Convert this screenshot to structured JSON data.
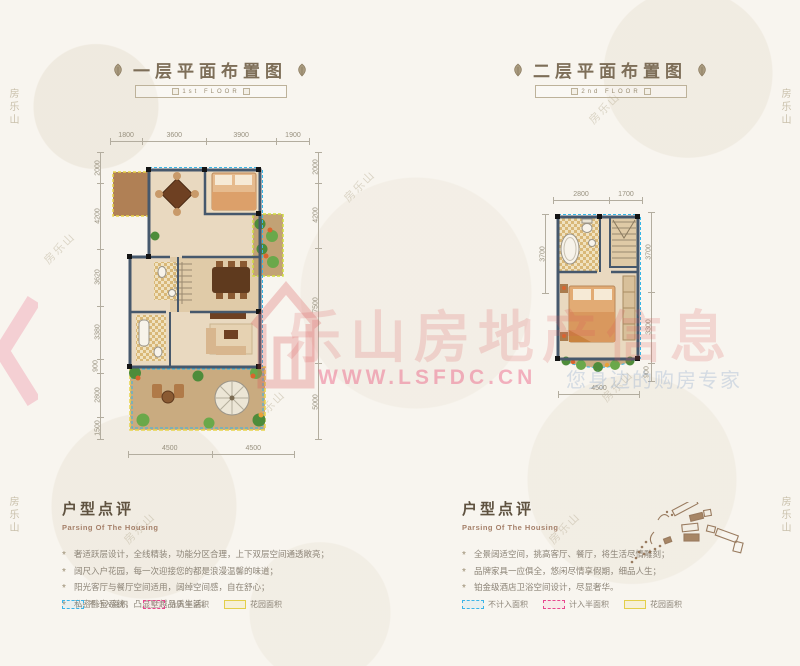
{
  "floor1": {
    "title": "一层平面布置图",
    "banner": "1st  FLOOR",
    "dims_top": [
      "1800",
      "3600",
      "3900",
      "1900"
    ],
    "dims_left": [
      "2000",
      "4200",
      "3620",
      "3380",
      "900",
      "2800",
      "1500"
    ],
    "dims_right": [
      "2000",
      "4200",
      "7500",
      "5000"
    ],
    "dims_bottom": [
      "4500",
      "4500"
    ]
  },
  "floor2": {
    "title": "二层平面布置图",
    "banner": "2nd  FLOOR",
    "dims_top": [
      "2800",
      "1700"
    ],
    "dims_left": [
      "3700"
    ],
    "dims_right": [
      "3700",
      "3300",
      "900"
    ],
    "dims_bottom": [
      "4500"
    ]
  },
  "watermark": {
    "brand_text": "乐山房地产信息",
    "url_text": "WWW.LSFDC.CN",
    "tagline": "您身边的购房专家",
    "corner_text": "房乐山"
  },
  "review_left": {
    "heading": "户型点评",
    "subheading": "Parsing Of The Housing",
    "bullets": [
      "奢适跃层设计，全线精装，功能分区合理，上下双层空间通透敞亮；",
      "阔尺入户花园，每一次迎接您的都是浪漫温馨的味道；",
      "阳光客厅与餐厅空间适用，阔绰空间感，自在舒心；",
      "私密卧室系统，凸显墅越品质生活。"
    ]
  },
  "review_right": {
    "heading": "户型点评",
    "subheading": "Parsing Of The Housing",
    "bullets": [
      "全景阔适空间，挑高客厅、餐厅，将生活尽情雕刻；",
      "品牌家具一应俱全，悠闲尽情享假期，细品人生；",
      "铂金级酒店卫浴空间设计，尽显奢华。"
    ]
  },
  "legend": {
    "items": [
      {
        "label": "不计入面积",
        "color": "#3bb4e8"
      },
      {
        "label": "计入半面积",
        "color": "#e8468e"
      },
      {
        "label": "花园面积",
        "color": "#e3cf4a"
      }
    ]
  },
  "colors": {
    "accent_red": "#d94f4f",
    "wall": "#46586c",
    "garden_dash": "#e8d44a",
    "balcony_dash": "#35b6e8"
  }
}
